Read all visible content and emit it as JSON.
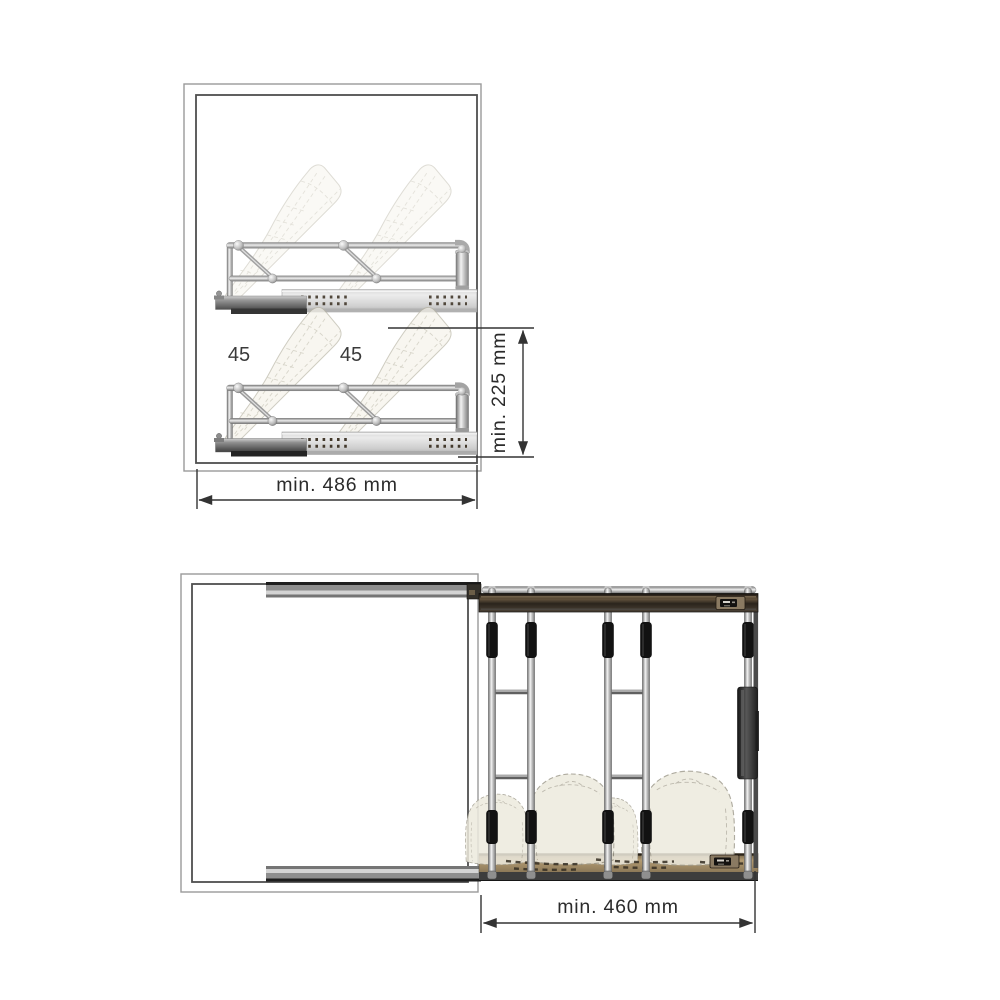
{
  "page": {
    "background": "#ffffff",
    "subject": "pull-out shoe rack installation drawing"
  },
  "side_view": {
    "angle_label_1": "45",
    "angle_label_2": "45",
    "width_dimension": "min. 486 mm",
    "height_dimension": "min. 225 mm"
  },
  "top_view": {
    "width_dimension": "min. 460 mm"
  },
  "colors": {
    "dimension_line": "#333333",
    "cabinet_outer": "#9a9a9a",
    "cabinet_inner": "#4f4f4f",
    "chrome_light": "#f2f2f2",
    "chrome_dark": "#6f6f6f",
    "grip_black": "#121212",
    "bar_bronze": "#63523d",
    "wood_tan": "#b29a71",
    "slide_gray": "#d9d9d9",
    "shoe_fill": "#f5f3ea"
  }
}
